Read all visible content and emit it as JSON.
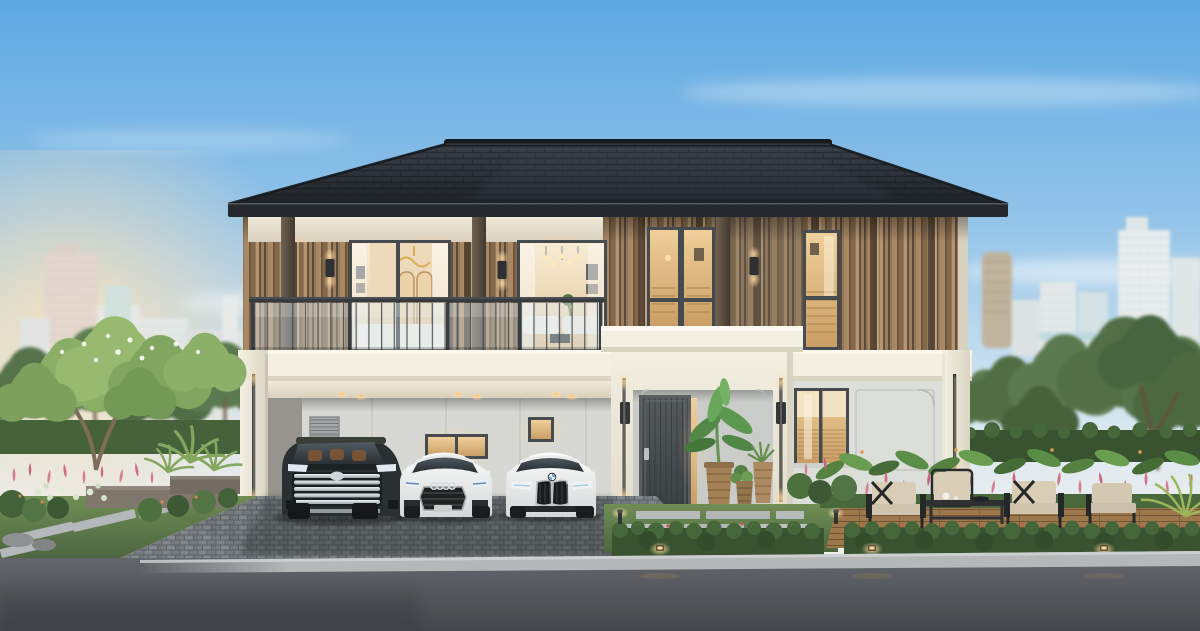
{
  "image": {
    "type": "photorealistic exterior architectural rendering",
    "subject": "modern two-storey detached luxury house at dusk with carport, glass balcony, tropical landscaping, three parked cars and a city skyline backdrop",
    "width_px": 1200,
    "height_px": 631
  },
  "palette": {
    "sky_top": "#57a5e2",
    "sky_mid": "#8fc2ea",
    "sky_low": "#cfe2f1",
    "sky_horizon": "#f6f1e4",
    "sun_glow": "#ffe2b5",
    "roof_hi": "#343b44",
    "roof_lo": "#171b21",
    "fascia": "#1d2126",
    "wood_slat": "#8d7256",
    "wood_batten": "#4c3b2a",
    "trim_white": "#f3efe2",
    "wall_grey": "#d6d7d3",
    "wall_wing": "#dbddd9",
    "window_frame": "#3e4449",
    "door_hi": "#4e5356",
    "door_lo": "#34393c",
    "interior_warm_hi": "#f8ecd3",
    "interior_warm_lo": "#e2c49a",
    "amber_hi": "#efcd97",
    "amber_lo": "#c89b60",
    "glass_tint": "#d5e4ec",
    "grass_hi": "#6b8a4f",
    "grass_lo": "#46603a",
    "hedge": "#314d2a",
    "flower_pink": "#d5798e",
    "paver": "#7b8085",
    "deck_wood": "#9a7347",
    "road_hi": "#5d6166",
    "road_lo": "#3d4146",
    "curb": "#b2b5b7",
    "car_black": "#22272a",
    "car_white_hi": "#fafbfb",
    "car_white_lo": "#d3d7d8",
    "chrome": "#cfd5da",
    "light_warm": "#ffd9a0",
    "led_white": "#fff6df",
    "cushion": "#d8cbb5",
    "city_haze": "#e9eceb",
    "foliage_light": "#7ba25c",
    "foliage_mid": "#4e7340",
    "foliage_dark": "#35522e",
    "trunk": "#7a6753"
  },
  "scene": {
    "time_of_day": "dusk, interior lights on, soft sun glow low on the left",
    "background": {
      "city_skyline_left": "hazy residential and office towers",
      "city_skyline_right": "hazy towers incl. bronze cylindrical tower",
      "tree_line": "dense green trees in front of skyline"
    },
    "house": {
      "storeys": 2,
      "roof": "dark charcoal hipped tile roof with wide eaves",
      "upper_floor": "vertical timber slat cladding, glass balustrade balcony, two large lit sliding windows, two narrow lit windows, wall sconces",
      "lower_floor": "double carport with downlights, cream fascia band, central white entrance portal with vertical LED strips, charcoal front door with smart lock, potted banana plants, right wing with lit window"
    },
    "vehicles": [
      {
        "type": "luxury minivan",
        "color": "black",
        "grille": "multi-bar chrome",
        "position": "left carport bay"
      },
      {
        "type": "sedan",
        "color": "white",
        "grille": "wide hexagonal with four-ring badge",
        "position": "middle carport bay"
      },
      {
        "type": "sedan",
        "color": "white",
        "grille": "twin kidney with roundel badge",
        "position": "right carport bay"
      }
    ],
    "landscape": {
      "front": "clipped hedge with warm path lights, lawn with stepping slabs, grey paver driveway, dark asphalt road",
      "right": "outdoor lounge set of armchairs and coffee table on timber deck amid pink ginger flowers and tall hedge",
      "left": "layered garden beds, ferns, white caladiums, planter walls and a light-green flowering tree"
    }
  }
}
